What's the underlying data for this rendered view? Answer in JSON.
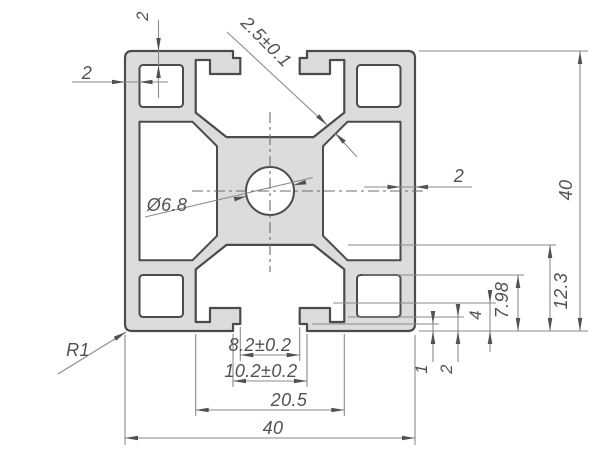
{
  "drawing": {
    "type": "technical-drawing",
    "subject": "aluminum-extrusion-profile-cross-section",
    "dimensions": {
      "top_wall": "2",
      "left_wall": "2",
      "web_thickness": "2.5±0.1",
      "center_hole": "Ø6.8",
      "right_wall": "2",
      "overall_height": "40",
      "slot_depth_major": "12.3",
      "corner_hole_height": "7.98",
      "lip_tip_height": "4",
      "lip_root_height": "2",
      "lip_ledge_height": "1",
      "slot_tab_width": "8.2±0.2",
      "slot_opening_width": "10.2±0.2",
      "channel_width": "20.5",
      "overall_width": "40",
      "corner_radius": "R1"
    },
    "colors": {
      "background": "#ffffff",
      "profile_fill": "#dcdcdc",
      "profile_outline": "#4e4a47",
      "dimension_line": "#8e8a87",
      "text": "#55504c"
    }
  }
}
